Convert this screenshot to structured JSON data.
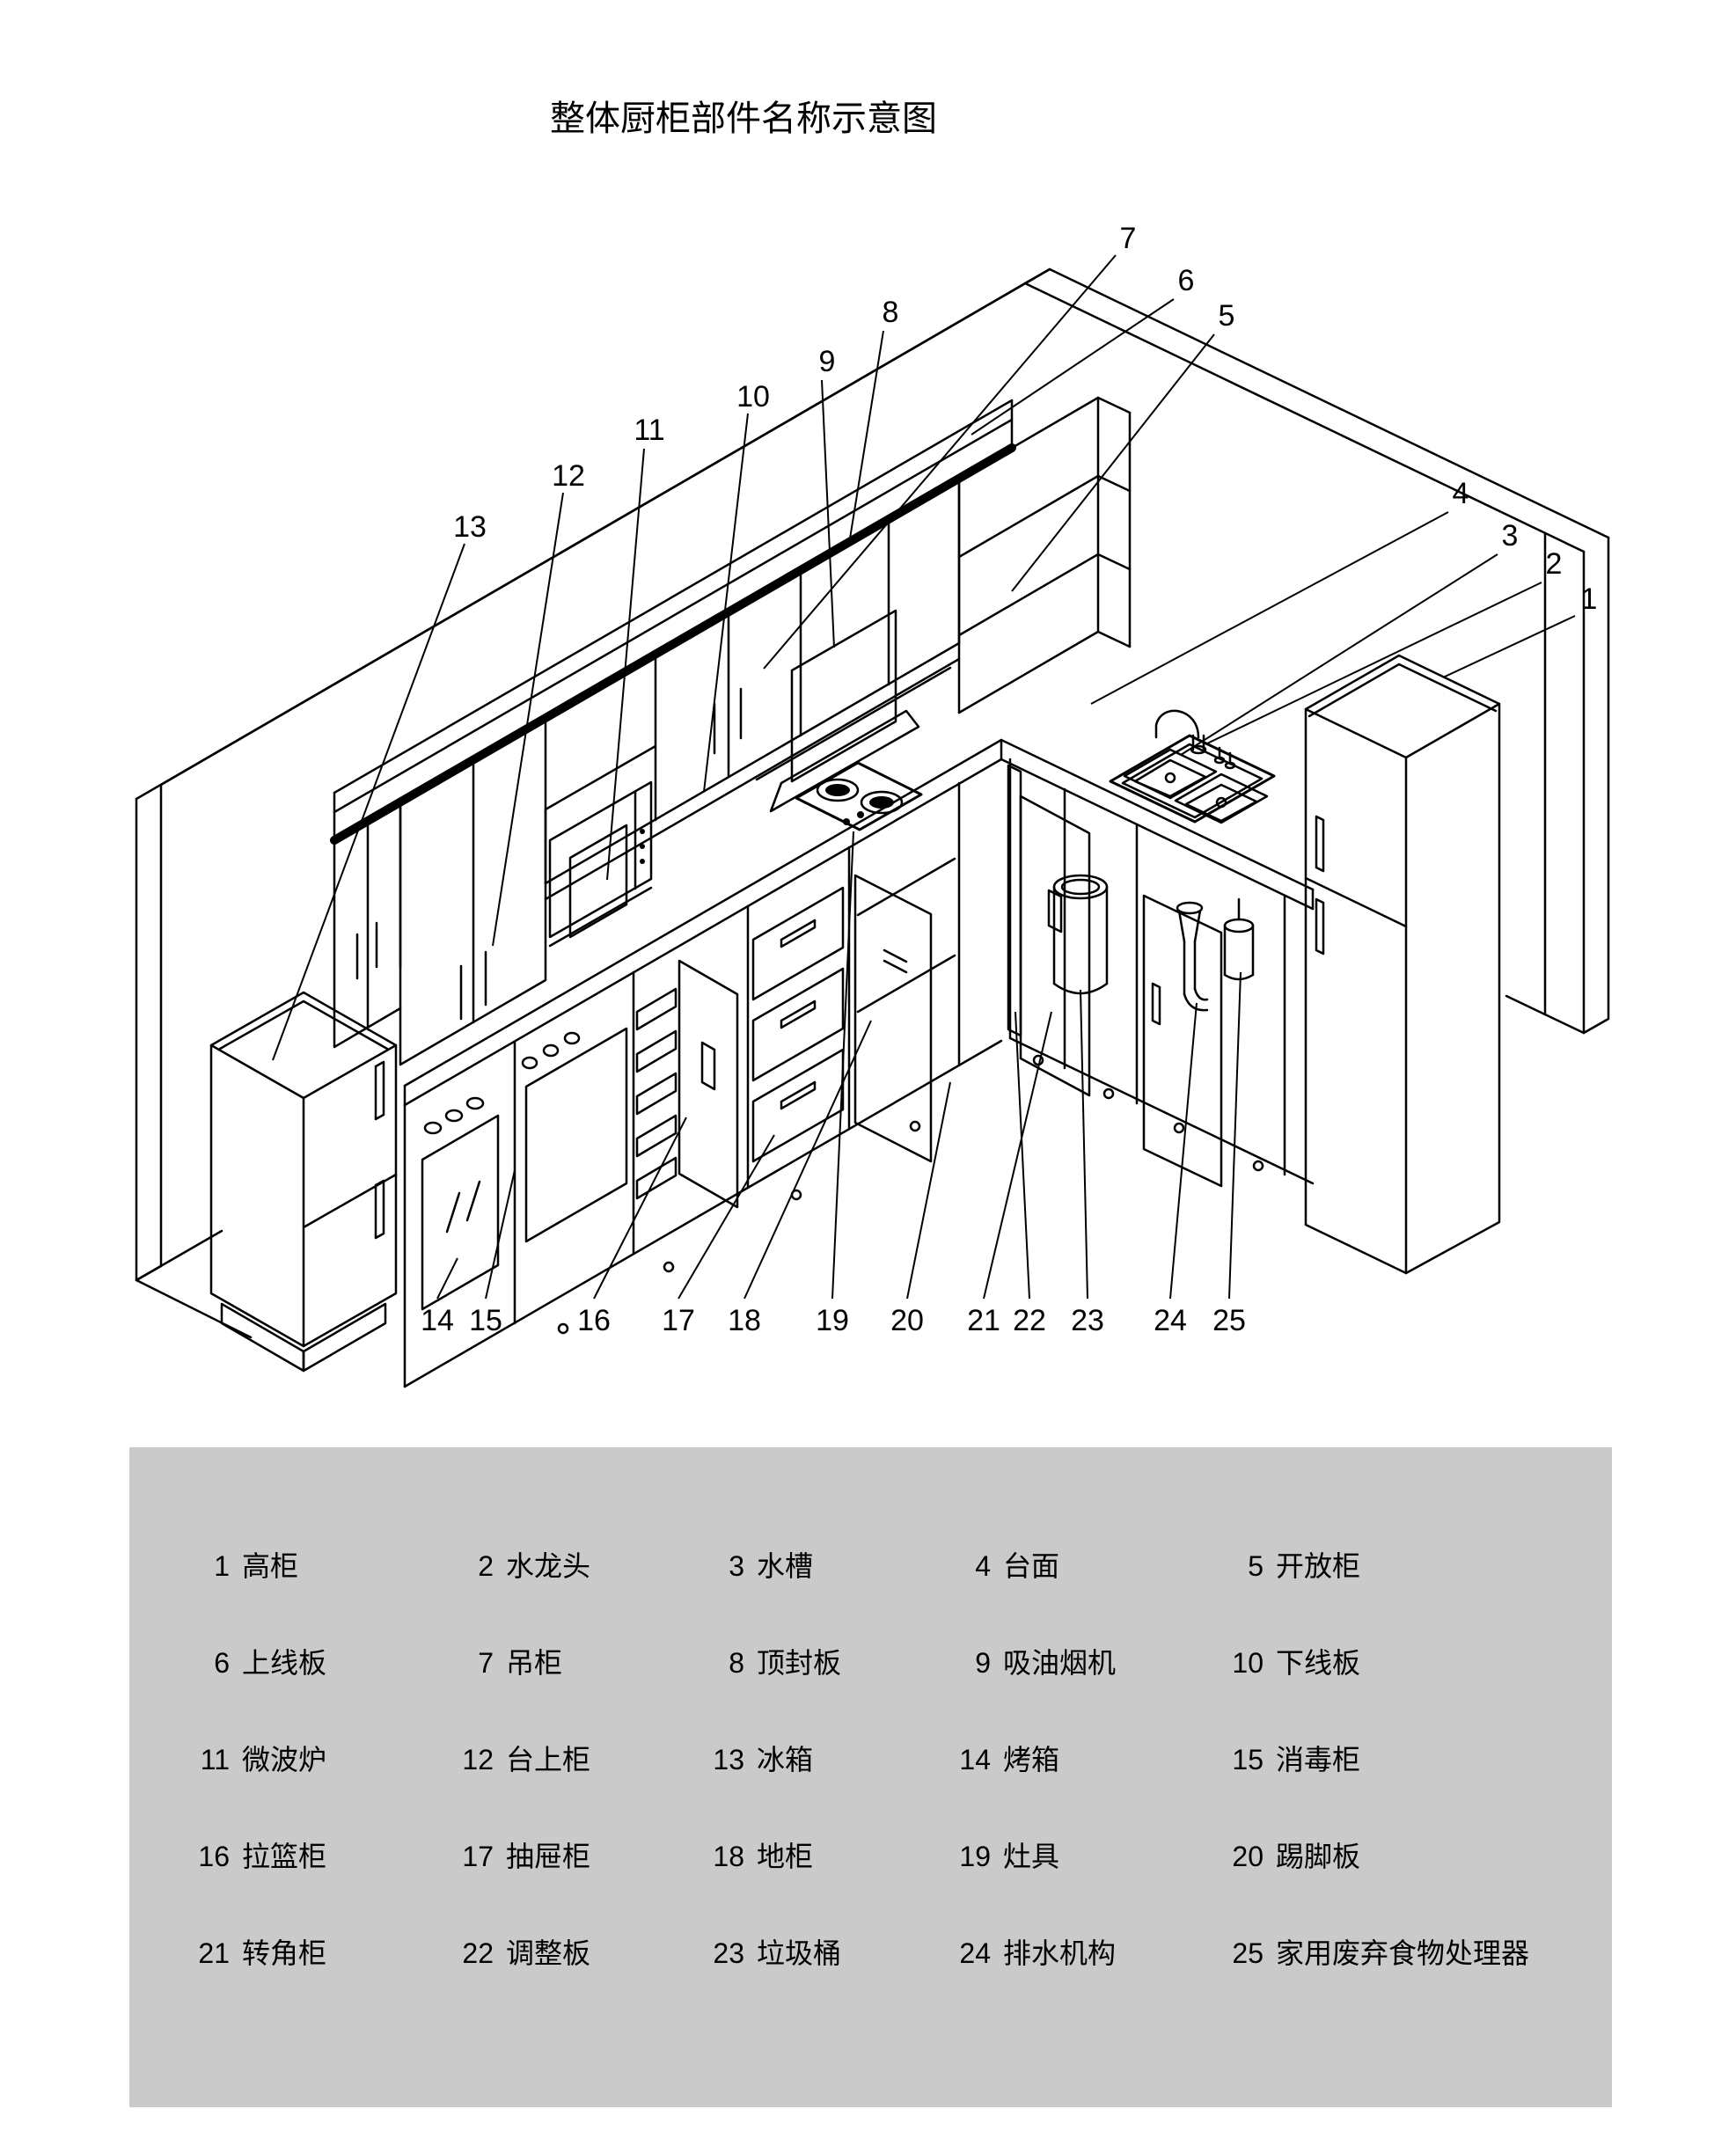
{
  "title": "整体厨柜部件名称示意图",
  "diagram": {
    "callouts": [
      "1",
      "2",
      "3",
      "4",
      "5",
      "6",
      "7",
      "8",
      "9",
      "10",
      "11",
      "12",
      "13",
      "14",
      "15",
      "16",
      "17",
      "18",
      "19",
      "20",
      "21",
      "22",
      "23",
      "24",
      "25"
    ]
  },
  "legend": {
    "items": [
      {
        "n": "1",
        "label": "高柜"
      },
      {
        "n": "2",
        "label": "水龙头"
      },
      {
        "n": "3",
        "label": "水槽"
      },
      {
        "n": "4",
        "label": "台面"
      },
      {
        "n": "5",
        "label": "开放柜"
      },
      {
        "n": "6",
        "label": "上线板"
      },
      {
        "n": "7",
        "label": "吊柜"
      },
      {
        "n": "8",
        "label": "顶封板"
      },
      {
        "n": "9",
        "label": "吸油烟机"
      },
      {
        "n": "10",
        "label": "下线板"
      },
      {
        "n": "11",
        "label": "微波炉"
      },
      {
        "n": "12",
        "label": "台上柜"
      },
      {
        "n": "13",
        "label": "冰箱"
      },
      {
        "n": "14",
        "label": "烤箱"
      },
      {
        "n": "15",
        "label": "消毒柜"
      },
      {
        "n": "16",
        "label": "拉篮柜"
      },
      {
        "n": "17",
        "label": "抽屉柜"
      },
      {
        "n": "18",
        "label": "地柜"
      },
      {
        "n": "19",
        "label": "灶具"
      },
      {
        "n": "20",
        "label": "踢脚板"
      },
      {
        "n": "21",
        "label": "转角柜"
      },
      {
        "n": "22",
        "label": "调整板"
      },
      {
        "n": "23",
        "label": "垃圾桶"
      },
      {
        "n": "24",
        "label": "排水机构"
      },
      {
        "n": "25",
        "label": "家用废弃食物处理器"
      }
    ]
  }
}
